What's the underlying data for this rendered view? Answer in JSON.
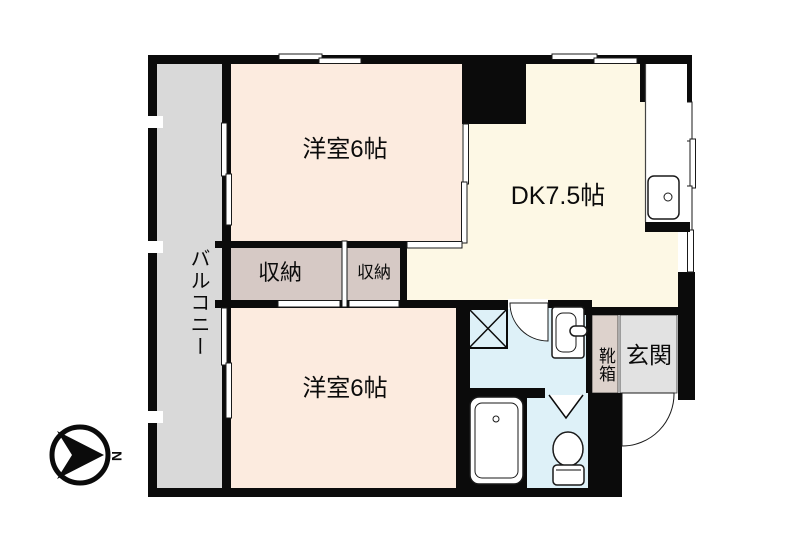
{
  "plan": {
    "rooms": {
      "western_room_top": "洋室6帖",
      "dining_kitchen": "DK7.5帖",
      "western_room_bottom": "洋室6帖",
      "closet_large": "収納",
      "closet_small": "収納",
      "balcony": "バルコニー",
      "entrance": "玄関",
      "shoe_cabinet": "靴箱"
    },
    "compass": {
      "north": "N"
    },
    "colors": {
      "wall": "#0b0b0b",
      "room_peach": "#fcebdf",
      "dk_cream": "#fdf8e5",
      "closet_mauve": "#d6c9c5",
      "balcony_gray": "#d9d9d9",
      "entrance_gray": "#e2e2e2",
      "shoe_mauve": "#ddd2cc",
      "water_blue": "#def1f8",
      "line": "#1a1a1a"
    }
  }
}
